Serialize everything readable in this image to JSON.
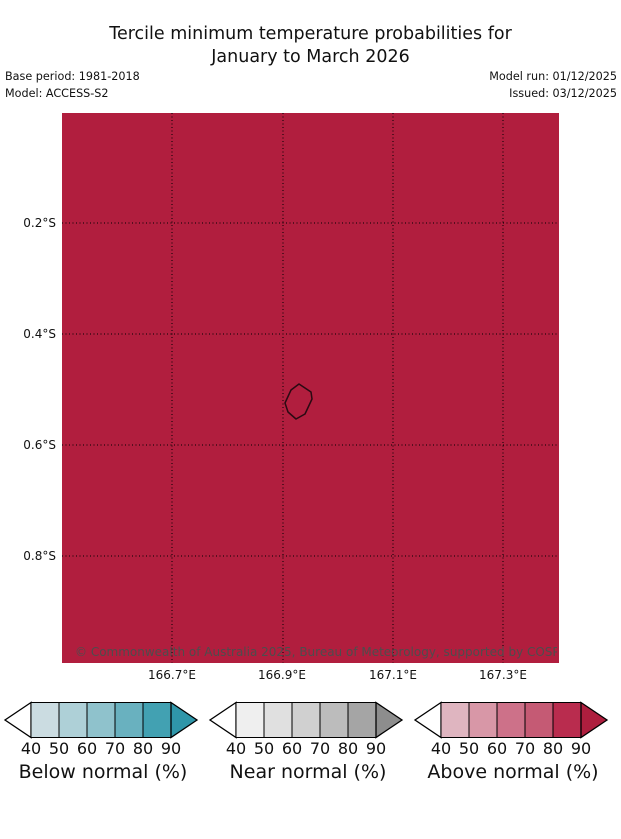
{
  "header": {
    "title_line1": "Tercile minimum temperature probabilities for",
    "title_line2": "January to March 2026",
    "base_period": "Base period: 1981-2018",
    "model": "Model: ACCESS-S2",
    "model_run": "Model run: 01/12/2025",
    "issued": "Issued: 03/12/2025"
  },
  "map": {
    "fill_color": "#b11e3e",
    "island_outline_color": "#2a0a12",
    "copyright": "© Commonwealth of Australia 2025, Bureau of Meteorology, supported by COSPPac",
    "y_ticks": [
      "0.2°S",
      "0.4°S",
      "0.6°S",
      "0.8°S"
    ],
    "x_ticks": [
      "166.7°E",
      "166.9°E",
      "167.1°E",
      "167.3°E"
    ]
  },
  "legend": {
    "tick_labels": [
      "40",
      "50",
      "60",
      "70",
      "80",
      "90"
    ],
    "below": {
      "label": "Below normal (%)",
      "arrow_left": "#ffffff",
      "segments": [
        "#cbdce1",
        "#aed0d7",
        "#8fc2cc",
        "#69b1bf",
        "#42a1b2"
      ],
      "arrow_right": "#2f96a9"
    },
    "near": {
      "label": "Near normal (%)",
      "arrow_left": "#ffffff",
      "segments": [
        "#efefef",
        "#e0e0e0",
        "#d0d0d0",
        "#bcbcbc",
        "#a5a5a5"
      ],
      "arrow_right": "#8d8d8d"
    },
    "above": {
      "label": "Above normal (%)",
      "arrow_left": "#ffffff",
      "segments": [
        "#dfb5c0",
        "#d897a7",
        "#cd7189",
        "#c55a74",
        "#b92c4e"
      ],
      "arrow_right": "#ae1e3e"
    }
  },
  "chart_data": {
    "type": "heatmap",
    "title": "Tercile minimum temperature probabilities for January to March 2026",
    "model": "ACCESS-S2",
    "base_period": "1981-2018",
    "model_run": "01/12/2025",
    "issued": "03/12/2025",
    "x_axis": {
      "label": "Longitude",
      "ticks": [
        "166.7°E",
        "166.9°E",
        "167.1°E",
        "167.3°E"
      ],
      "range": [
        "166.5°E",
        "167.4°E"
      ]
    },
    "y_axis": {
      "label": "Latitude",
      "ticks": [
        "0.2°S",
        "0.4°S",
        "0.6°S",
        "0.8°S"
      ],
      "range": [
        "0.0°S",
        "1.0°S"
      ]
    },
    "grid": "dotted, every 0.2 degrees",
    "legend_position": "bottom",
    "legend_bins_percent": [
      40,
      50,
      60,
      70,
      80,
      90
    ],
    "categories": [
      "Below normal (%)",
      "Near normal (%)",
      "Above normal (%)"
    ],
    "map_values": [
      {
        "region": "entire mapped area around island outline near 166.93°E 0.52°S",
        "category": "Above normal",
        "probability_percent": ">90"
      }
    ],
    "attribution": "© Commonwealth of Australia 2025, Bureau of Meteorology, supported by COSPPac"
  }
}
